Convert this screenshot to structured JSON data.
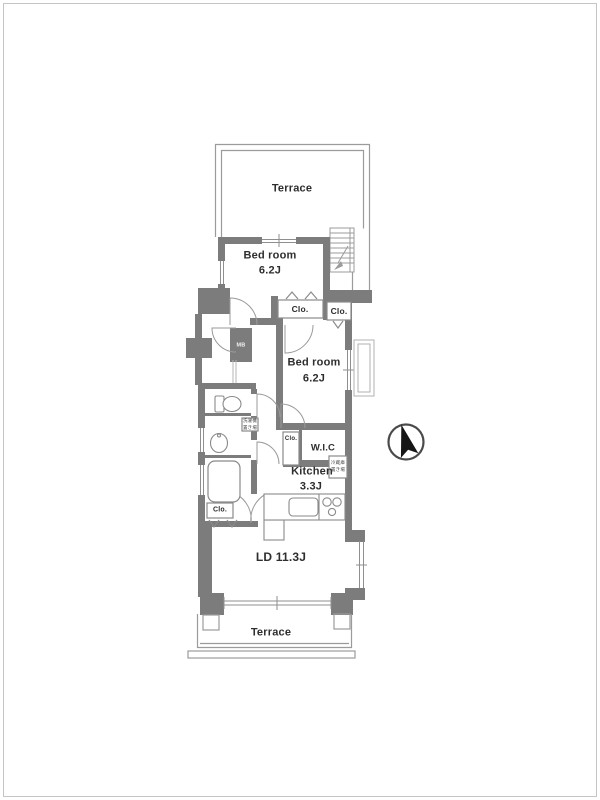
{
  "plan_type": "apartment-floor-plan",
  "colors": {
    "wall": "#7c7c7c",
    "outline": "#999999",
    "fixture": "#8a8a8a",
    "text": "#2e2e2e",
    "compass": "#161616",
    "frame": "#c5c5c5"
  },
  "labels": {
    "terrace_top": "Terrace",
    "bedroom1_name": "Bed room",
    "bedroom1_size": "6.2J",
    "closet1": "Clo.",
    "closet2": "Clo.",
    "bedroom2_name": "Bed room",
    "bedroom2_size": "6.2J",
    "wic": "W.I.C",
    "closet_hall": "Clo.",
    "kitchen_name": "Kitchen",
    "kitchen_size": "3.3J",
    "living_dining": "LD 11.3J",
    "closet3": "Clo.",
    "terrace_bottom": "Terrace",
    "meter_box": "MB",
    "fridge_note_1": "冷蔵庫",
    "fridge_note_2": "置き場",
    "washer_note_1": "洗濯機",
    "washer_note_2": "置き場"
  }
}
